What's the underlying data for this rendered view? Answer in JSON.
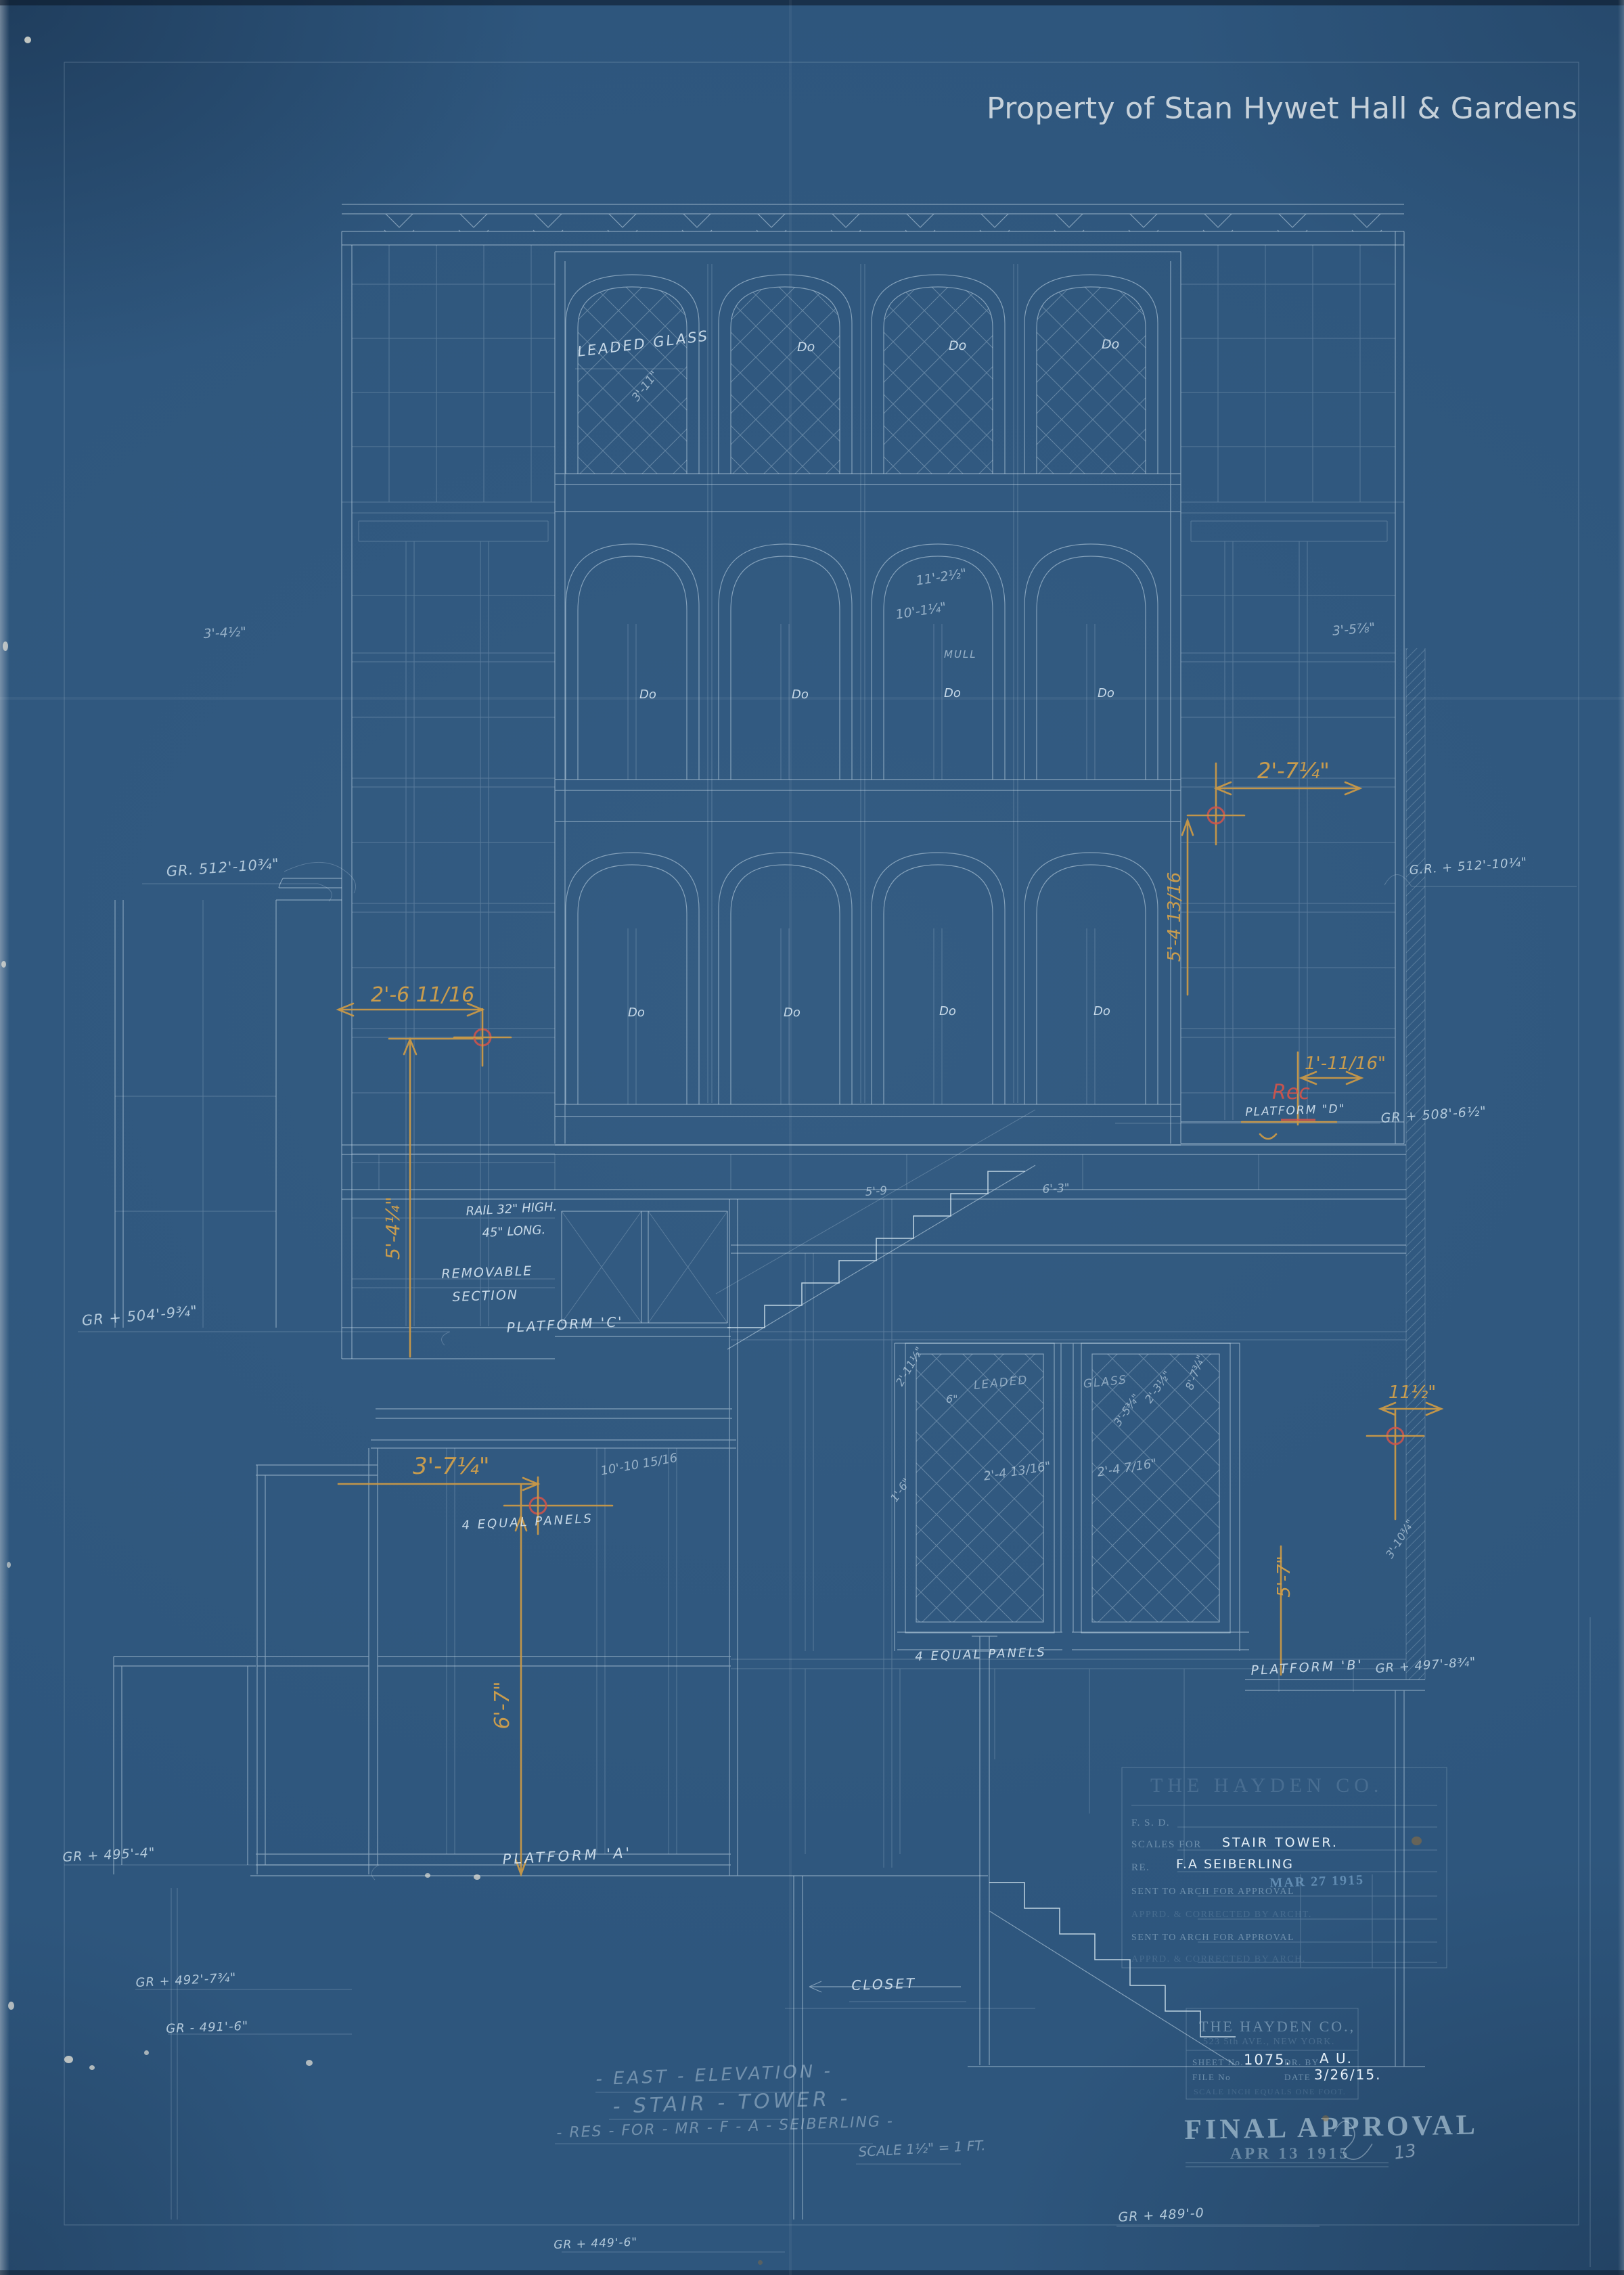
{
  "watermark": "Property of Stan Hywet Hall & Gardens",
  "labels": {
    "leaded_glass": "LEADED GLASS",
    "do_a1": "Do",
    "do_a2": "Do",
    "do_a3": "Do",
    "do_b1": "Do",
    "do_b2": "Do",
    "do_b3": "Do",
    "do_b4": "Do",
    "do_c1": "Do",
    "do_c2": "Do",
    "do_c3": "Do",
    "do_c4": "Do",
    "mull": "MULL",
    "rail_line1": "RAIL 32\" HIGH.",
    "rail_line2": "45\" LONG.",
    "removable1": "REMOVABLE",
    "removable2": "SECTION",
    "platform_a": "PLATFORM 'A'",
    "platform_b": "PLATFORM 'B'",
    "platform_c": "PLATFORM 'C'",
    "platform_d": "PLATFORM \"D\"",
    "equal_panels1": "4 EQUAL PANELS",
    "equal_panels2": "4 EQUAL PANELS",
    "leaded": "LEADED",
    "glass": "GLASS",
    "closet": "CLOSET"
  },
  "dims_white": {
    "w311": "3'-11\"",
    "w1125": "11'-2½\"",
    "w1014": "10'-1¼\"",
    "w345": "3'-4½\"",
    "w358": "3'-5⅞\"",
    "w59": "5'-9",
    "w63": "6'-3\"",
    "w101015": "10'-10 15/16",
    "w2413": "2'-4 13/16\"",
    "w247": "2'-4 7/16\"",
    "w334": "3'-5¾\"",
    "w235": "2'-3½\"",
    "w6": "6\"",
    "w16": "1'-6\"",
    "w2115": "2'-11½\"",
    "w3103": "3'-10¾\"",
    "w873": "8'-7¾\""
  },
  "grades": {
    "g512l": "GR. 512'-10¾\"",
    "g512r": "G.R. + 512'-10¼\"",
    "g508": "GR + 508'-6½\"",
    "g504": "GR + 504'-9¾\"",
    "g497": "GR + 497'-8¾\"",
    "g495": "GR + 495'-4\"",
    "g492": "GR + 492'-7¾\"",
    "g491": "GR - 491'-6\"",
    "g489": "GR + 489'-0",
    "g449": "GR + 449'-6\""
  },
  "dims_orange": {
    "o2611": "2'-6 11/16",
    "o544": "5'-4¼\"",
    "o274": "2'-7¼\"",
    "o5413": "5'-4 13/16",
    "o1116": "1'-11/16\"",
    "o374": "3'-7¼\"",
    "o67": "6'-7\"",
    "o115": "11½\"",
    "o57": "5'-7\"",
    "rec": "Rec"
  },
  "titleblock": {
    "company": "THE HAYDEN CO.",
    "fsd": "F. S. D.",
    "scales_for": "SCALES FOR",
    "scales_value": "STAIR TOWER.",
    "re": "RE.",
    "re_value": "F.A SEIBERLING",
    "sent1": "SENT TO ARCH FOR APPROVAL",
    "sent1_date": "MAR 27 1915",
    "apprd1": "APPRD. & CORRECTED BY ARCHT.",
    "sent2": "SENT TO ARCH FOR APPROVAL",
    "apprd2": "APPRD. & CORRECTED BY ARCH."
  },
  "stampbox": {
    "company": "THE HAYDEN CO.,",
    "address": "523 5th AVE., NEW YORK.",
    "sheet_label": "SHEET No.",
    "sheet_value": "1075.",
    "drby_label": "DR. BY",
    "drby_value": "A U.",
    "file_label": "FILE No",
    "date_label": "DATE",
    "date_value": "3/26/15.",
    "scale_line": "SCALE      INCH EQUALS ONE FOOT."
  },
  "approval": {
    "stamp": "FINAL APPROVAL",
    "date": "APR 13 1915",
    "mark": "13"
  },
  "footer": {
    "line1": "- EAST - ELEVATION -",
    "line2": "- STAIR - TOWER -",
    "line3": "- RES - FOR - MR - F - A - SEIBERLING -",
    "scale_note": "SCALE 1½\" = 1 FT."
  }
}
